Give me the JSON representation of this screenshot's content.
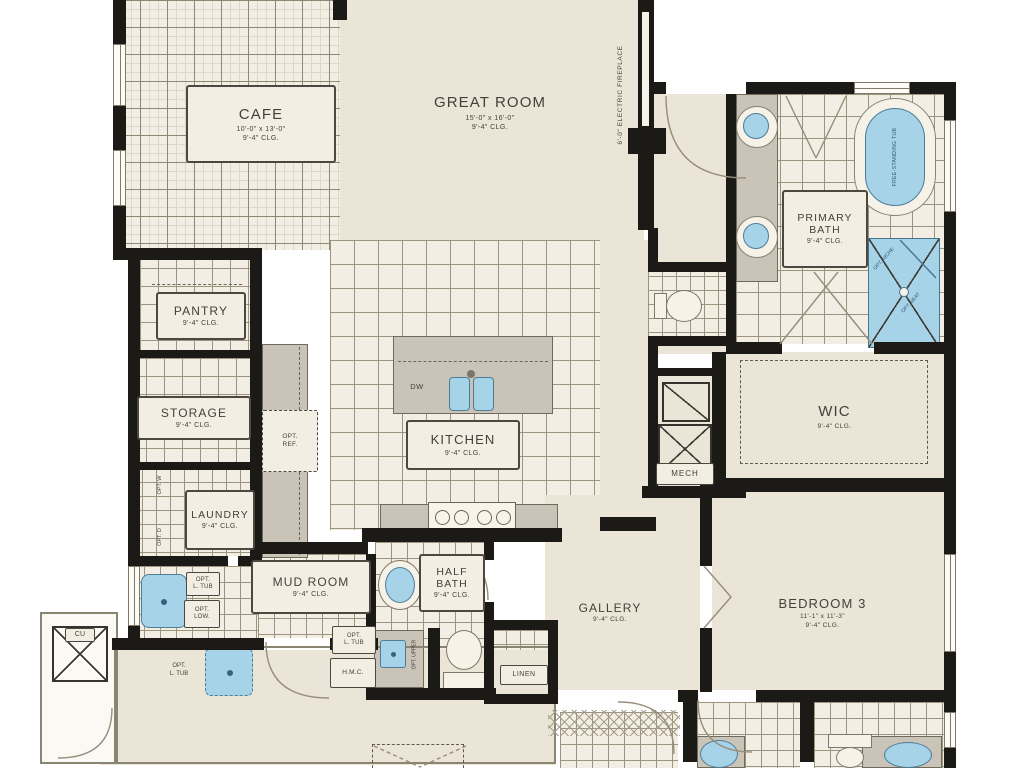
{
  "rooms": {
    "cafe": {
      "name": "CAFE",
      "dims": "10'-0\" x 13'-0\"",
      "clg": "9'-4\" CLG."
    },
    "great_room": {
      "name": "GREAT ROOM",
      "dims": "15'-0\" x 16'-0\"",
      "clg": "9'-4\" CLG."
    },
    "primary_bath": {
      "name": "PRIMARY BATH",
      "clg": "9'-4\" CLG."
    },
    "wic": {
      "name": "WIC",
      "clg": "9'-4\" CLG."
    },
    "mech": {
      "name": "MECH"
    },
    "pantry": {
      "name": "PANTRY",
      "clg": "9'-4\" CLG."
    },
    "storage": {
      "name": "STORAGE",
      "clg": "9'-4\" CLG."
    },
    "kitchen": {
      "name": "KITCHEN",
      "clg": "9'-4\" CLG."
    },
    "laundry": {
      "name": "LAUNDRY",
      "clg": "9'-4\" CLG."
    },
    "mud_room": {
      "name": "MUD ROOM",
      "clg": "9'-4\" CLG."
    },
    "half_bath": {
      "name": "HALF BATH",
      "clg": "9'-4\" CLG."
    },
    "gallery": {
      "name": "GALLERY",
      "clg": "9'-4\" CLG."
    },
    "bedroom_3": {
      "name": "BEDROOM 3",
      "dims": "11'-1\" x 11'-3\"",
      "clg": "9'-4\" CLG."
    },
    "linen": {
      "name": "LINEN"
    },
    "cu": {
      "name": "CU"
    }
  },
  "annotations": {
    "fireplace": "6'-0\" ELECTRIC FIREPLACE",
    "tub": "FREE-STANDING TUB",
    "opt_niche": "OPT. NICHE",
    "opt_seat": "OPT. SEAT",
    "dw": "DW",
    "opt_ref_line1": "OPT.",
    "opt_ref_line2": "REF.",
    "opt_w": "OPT. W",
    "opt_d": "OPT. D",
    "opt_ltub_laundry_line1": "OPT.",
    "opt_ltub_laundry_line2": "L. TUB",
    "opt_low_line1": "OPT.",
    "opt_low_line2": "LOW.",
    "opt_ltub_mud_line1": "OPT.",
    "opt_ltub_mud_line2": "L. TUB",
    "hmc": "H.M.C.",
    "opt_upper": "OPT. UPPER",
    "opt_ltub_garage_line1": "OPT.",
    "opt_ltub_garage_line2": "L. TUB"
  },
  "colors": {
    "wall": "#1c1a16",
    "floor": "#ebe5d8",
    "tile": "#f3eee3",
    "fixture_blue": "#a7d3e9",
    "counter_gray": "#c9c3b8",
    "label_ink": "#45413a"
  }
}
